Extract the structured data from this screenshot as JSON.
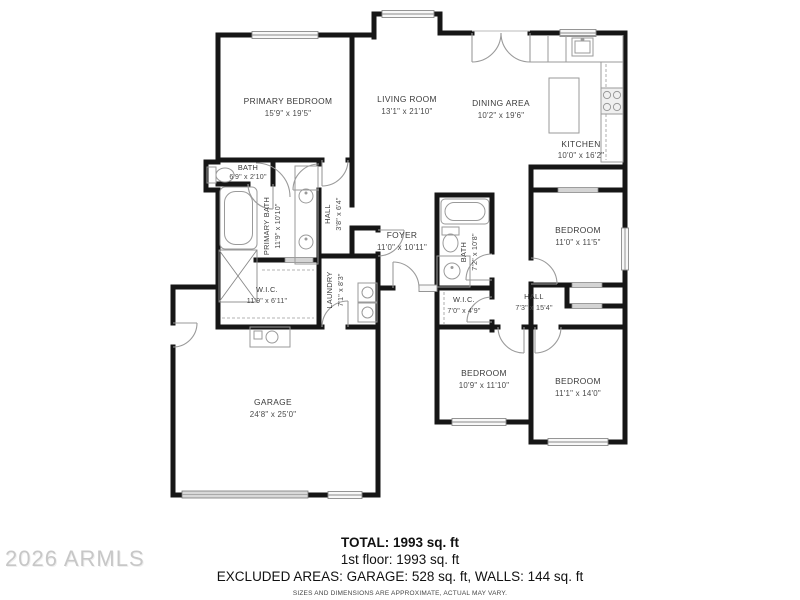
{
  "floorplan": {
    "rooms": {
      "primary_bedroom": {
        "name": "PRIMARY BEDROOM",
        "dims": "15'9\" x 19'5\""
      },
      "living_room": {
        "name": "LIVING ROOM",
        "dims": "13'1\" x 21'10\""
      },
      "dining_area": {
        "name": "DINING AREA",
        "dims": "10'2\" x 19'6\""
      },
      "kitchen": {
        "name": "KITCHEN",
        "dims": "10'0\" x 16'2\""
      },
      "bath_primary_wc": {
        "name": "BATH",
        "dims": "6'9\" x 2'10\""
      },
      "primary_bath": {
        "name": "PRIMARY BATH",
        "dims": "11'9\" x 10'10\""
      },
      "hall_primary": {
        "name": "HALL",
        "dims": "3'8\" x 6'4\""
      },
      "foyer": {
        "name": "FOYER",
        "dims": "11'0\" x 10'11\""
      },
      "laundry": {
        "name": "LAUNDRY",
        "dims": "7'1\" x 8'3\""
      },
      "wic_primary": {
        "name": "W.I.C.",
        "dims": "11'9\" x 6'11\""
      },
      "bath_hall": {
        "name": "BATH",
        "dims": "7'2\" x 10'8\""
      },
      "wic_hall": {
        "name": "W.I.C.",
        "dims": "7'0\" x 4'9\""
      },
      "hall_bedrooms": {
        "name": "HALL",
        "dims": "7'3\" x 15'4\""
      },
      "bedroom_ne": {
        "name": "BEDROOM",
        "dims": "11'0\" x 11'5\""
      },
      "bedroom_s": {
        "name": "BEDROOM",
        "dims": "10'9\" x 11'10\""
      },
      "bedroom_se": {
        "name": "BEDROOM",
        "dims": "11'1\" x 14'0\""
      },
      "garage": {
        "name": "GARAGE",
        "dims": "24'8\" x 25'0\""
      }
    },
    "summary": {
      "total": "TOTAL: 1993 sq. ft",
      "first_floor": "1st floor: 1993 sq. ft",
      "excluded": "EXCLUDED AREAS: GARAGE: 528 sq. ft, WALLS: 144 sq. ft",
      "disclaimer": "SIZES AND DIMENSIONS ARE APPROXIMATE, ACTUAL MAY VARY."
    },
    "watermark": "2026 ARMLS",
    "colors": {
      "wall": "#161616",
      "fixture": "#9a9a9a",
      "window_fill": "#f8f8f8",
      "garage_door": "#d8d8d8",
      "label": "#3a3a3a",
      "watermark": "#c7c7c7"
    }
  }
}
